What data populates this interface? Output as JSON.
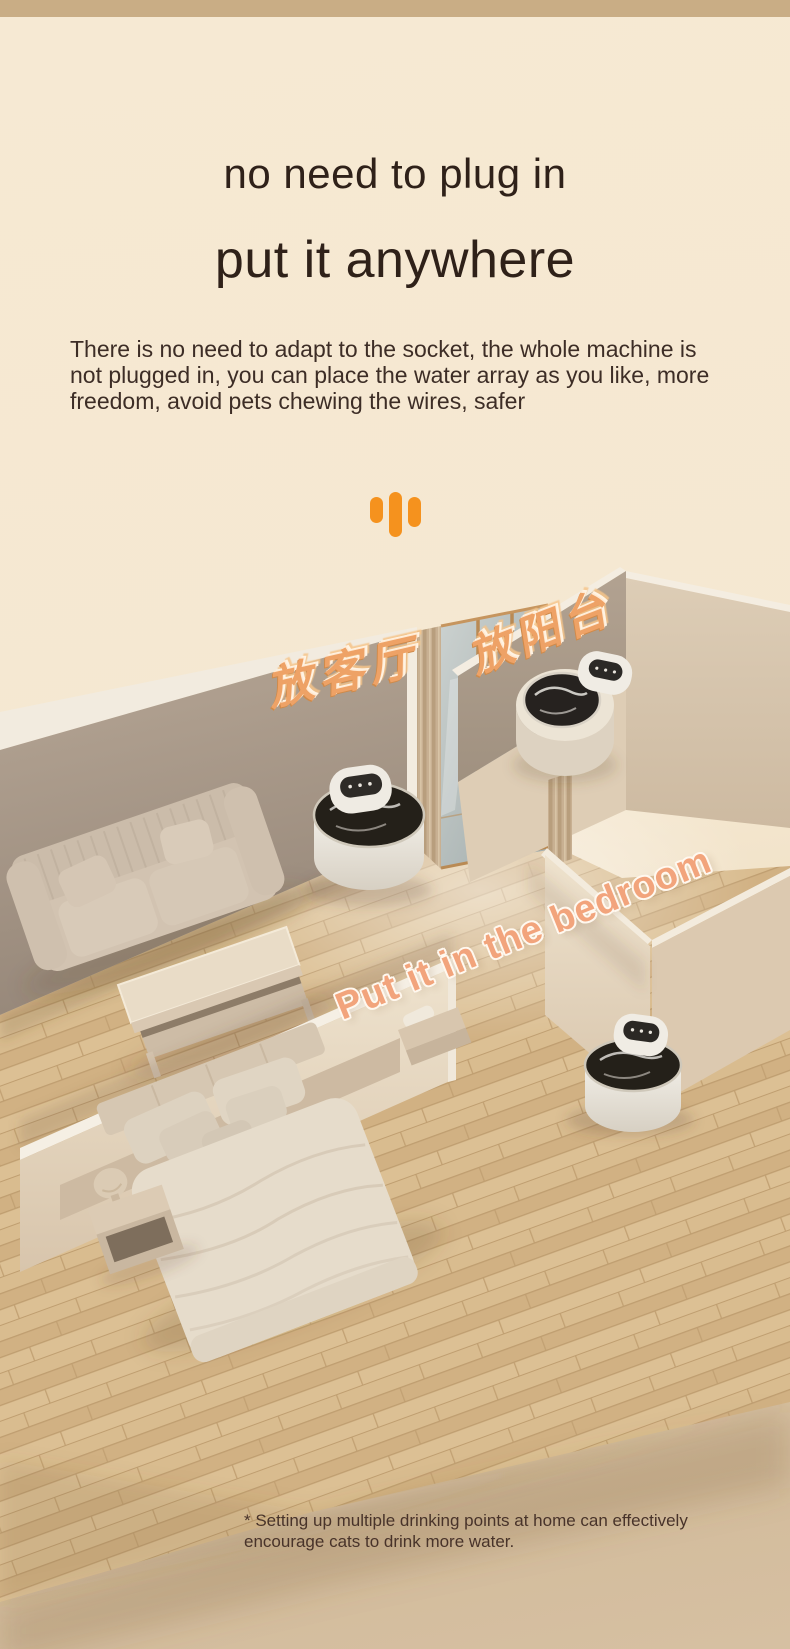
{
  "meta": {
    "top_strip_color": "#c9ad85",
    "background_top": "#f6e9d3",
    "background_bottom": "#d6c0a2",
    "accent_orange": "#f5921e",
    "headline_color": "#2f2119"
  },
  "hero": {
    "headline_line1": "no need to plug in",
    "headline_line2": "put it anywhere",
    "body": "There is no need to adapt to the socket, the whole machine is not plugged in, you can place the water array as you like, more freedom, avoid pets chewing the wires, safer",
    "decoration_icon": "three-orange-bars"
  },
  "scene": {
    "description": "isometric room render showing cordless cat water fountains placed in living room, balcony and bedroom",
    "labels": {
      "living_room": "放客厅",
      "balcony": "放阳台",
      "bedroom": "Put it in the bedroom"
    },
    "colors": {
      "wall_taupe": "#a89a89",
      "wall_light": "#e8dbc5",
      "floor_wood": "#d6b78a",
      "glass": "#b7bfbe",
      "glass_frame_gold": "#b98a54",
      "fountain_body": "#ece8e0",
      "fountain_water": "#242019",
      "label_gold": "#eea266",
      "label_peach": "#f2a47c"
    }
  },
  "footnote": {
    "text": "* Setting up multiple drinking points at home can effectively encourage cats to drink more water."
  }
}
